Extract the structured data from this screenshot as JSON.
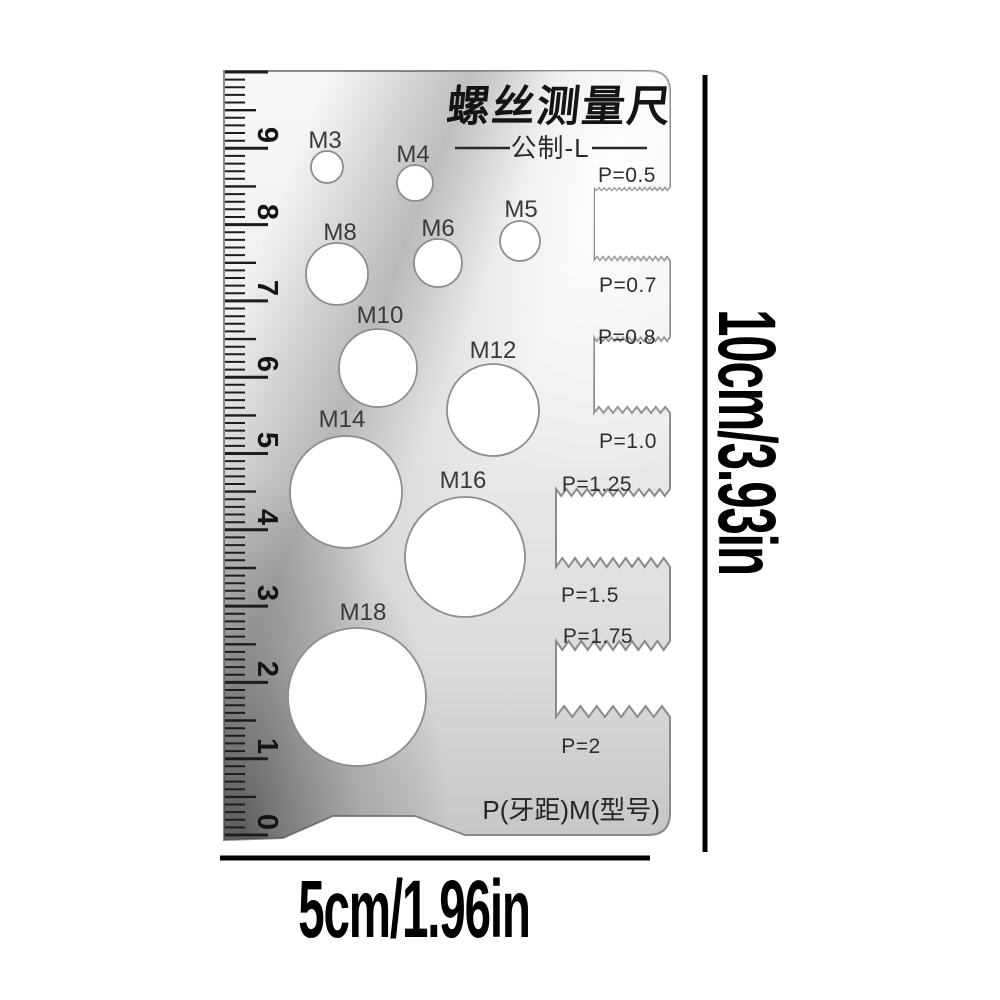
{
  "card": {
    "title": "螺丝测量尺",
    "subtitle": "公制-L",
    "footer_label": "P(牙距)M(型号)",
    "hole_labels": [
      "M3",
      "M4",
      "M5",
      "M6",
      "M8",
      "M10",
      "M12",
      "M14",
      "M16",
      "M18"
    ],
    "pitch_labels": [
      "P=0.5",
      "P=0.7",
      "P=0.8",
      "P=1.0",
      "P=1.25",
      "P=1.5",
      "P=1.75",
      "P=2"
    ],
    "ruler_numbers": [
      "9",
      "8",
      "7",
      "6",
      "5",
      "4",
      "3",
      "2",
      "1",
      "0"
    ]
  },
  "annotations": {
    "height_label": "10cm/3.93in",
    "width_label": "5cm/1.96in"
  },
  "colors": {
    "metal_light": "#f6f6f6",
    "metal_mid": "#dcdcdc",
    "metal_dark": "#8a8a8a",
    "hole_fill": "#ffffff",
    "ink": "#141414",
    "annotation_ink": "#000000"
  }
}
